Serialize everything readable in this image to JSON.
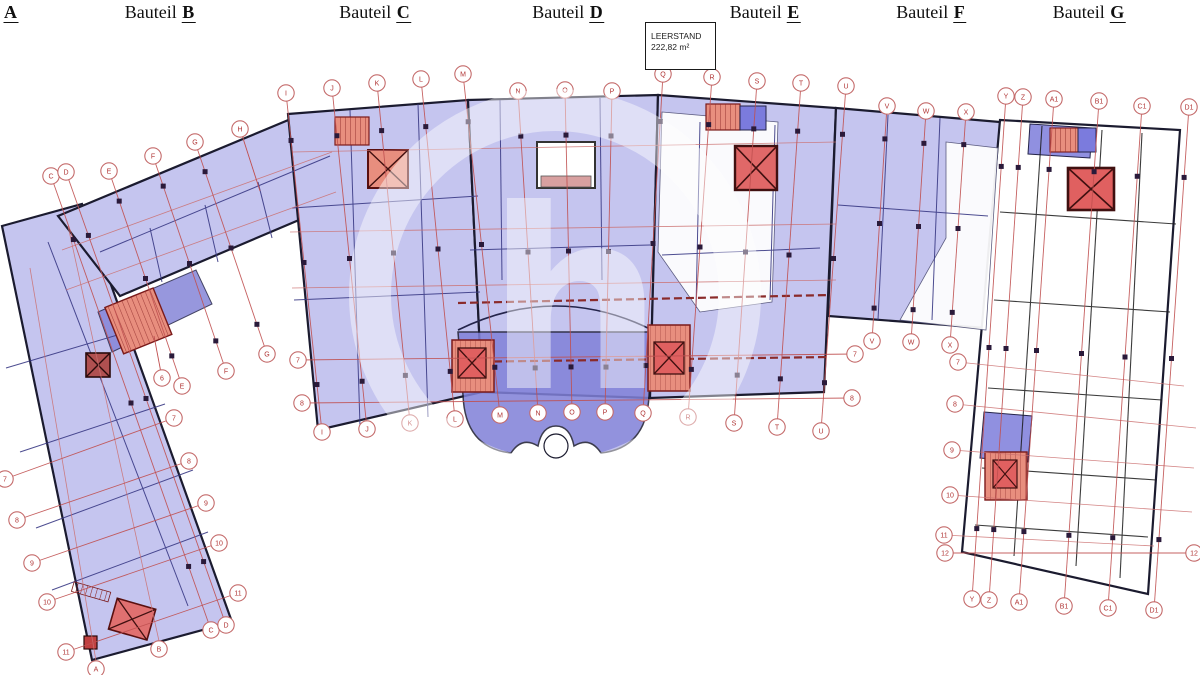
{
  "drawing": {
    "type": "building-floor-plan",
    "title_sections": [
      {
        "prefix": "Bauteil",
        "letter": "A"
      },
      {
        "prefix": "Bauteil",
        "letter": "B"
      },
      {
        "prefix": "Bauteil",
        "letter": "C"
      },
      {
        "prefix": "Bauteil",
        "letter": "D"
      },
      {
        "prefix": "Bauteil",
        "letter": "E"
      },
      {
        "prefix": "Bauteil",
        "letter": "F"
      },
      {
        "prefix": "Bauteil",
        "letter": "G"
      }
    ],
    "vacancy_box": {
      "line1": "LEERSTAND",
      "line2": "222,82 m²"
    },
    "watermark": "h",
    "grid_bubbles": [
      "C",
      "D",
      "E",
      "F",
      "G",
      "H",
      "I",
      "J",
      "K",
      "L",
      "M",
      "N",
      "O",
      "P",
      "Q",
      "R",
      "S",
      "T",
      "U",
      "V",
      "W",
      "X",
      "Y",
      "Z",
      "A1",
      "B1",
      "C1",
      "D1",
      "6",
      "E",
      "F",
      "G",
      "7",
      "8",
      "I",
      "J",
      "K",
      "L",
      "M",
      "N",
      "O",
      "P",
      "Q",
      "R",
      "S",
      "T",
      "U",
      "7",
      "8",
      "V",
      "W",
      "X",
      "7",
      "8",
      "9",
      "10",
      "11",
      "12",
      "Y",
      "Z",
      "A1",
      "B1",
      "C1",
      "D1",
      "12",
      "7",
      "8",
      "9",
      "10",
      "11",
      "7",
      "8",
      "9",
      "10",
      "11",
      "A",
      "B",
      "C",
      "D"
    ],
    "colors": {
      "floorplate": "#c5c5ef",
      "highlight_zone": "#8080d8",
      "stair_core": "#e88e7e",
      "grid_line": "#c05050",
      "outline": "#1b1b2f",
      "vacant": "#ffffff"
    }
  }
}
